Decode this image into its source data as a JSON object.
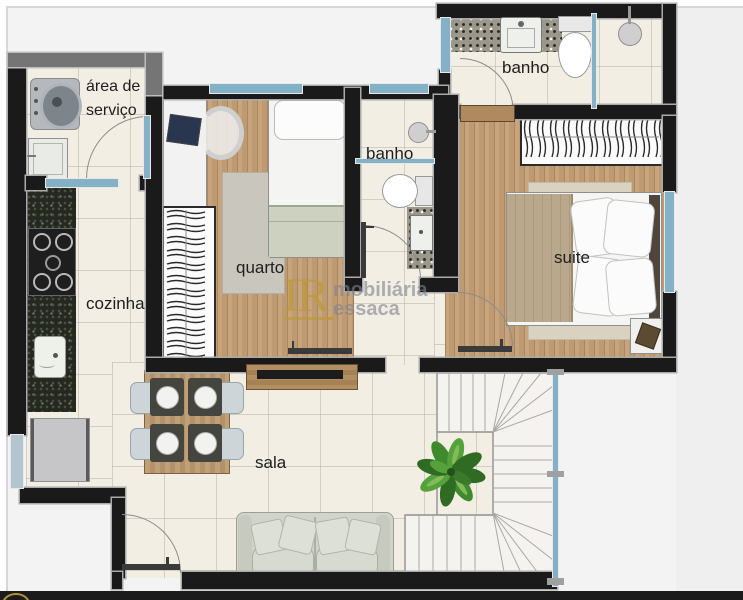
{
  "watermark": {
    "initials": "IR",
    "company_line1": "Imobiliária",
    "company_line2": "Ressaca",
    "display_line1_rest": "mobiliária",
    "display_line2_rest": "essaca"
  },
  "rooms": {
    "service_area": {
      "label_line1": "área de",
      "label_line2": "serviço"
    },
    "kitchen": {
      "label": "cozinha"
    },
    "bedroom": {
      "label": "quarto"
    },
    "hall_bathroom": {
      "label": "banho"
    },
    "suite_bathroom": {
      "label": "banho"
    },
    "suite": {
      "label": "suite"
    },
    "living_room": {
      "label": "sala"
    }
  },
  "colors": {
    "wall": "#1a1a1a",
    "window_glass": "#84b1c6",
    "wood_floor": "#bd9a72",
    "marble_floor": "#f2eee3",
    "granite_counter": "#242821",
    "watermark_gold": "#c2a04f",
    "watermark_gray": "#8d8f99",
    "plant_green": "#3f7d2e",
    "sofa": "#d0d4cb",
    "bottom_bar": "#1b1b1b"
  }
}
